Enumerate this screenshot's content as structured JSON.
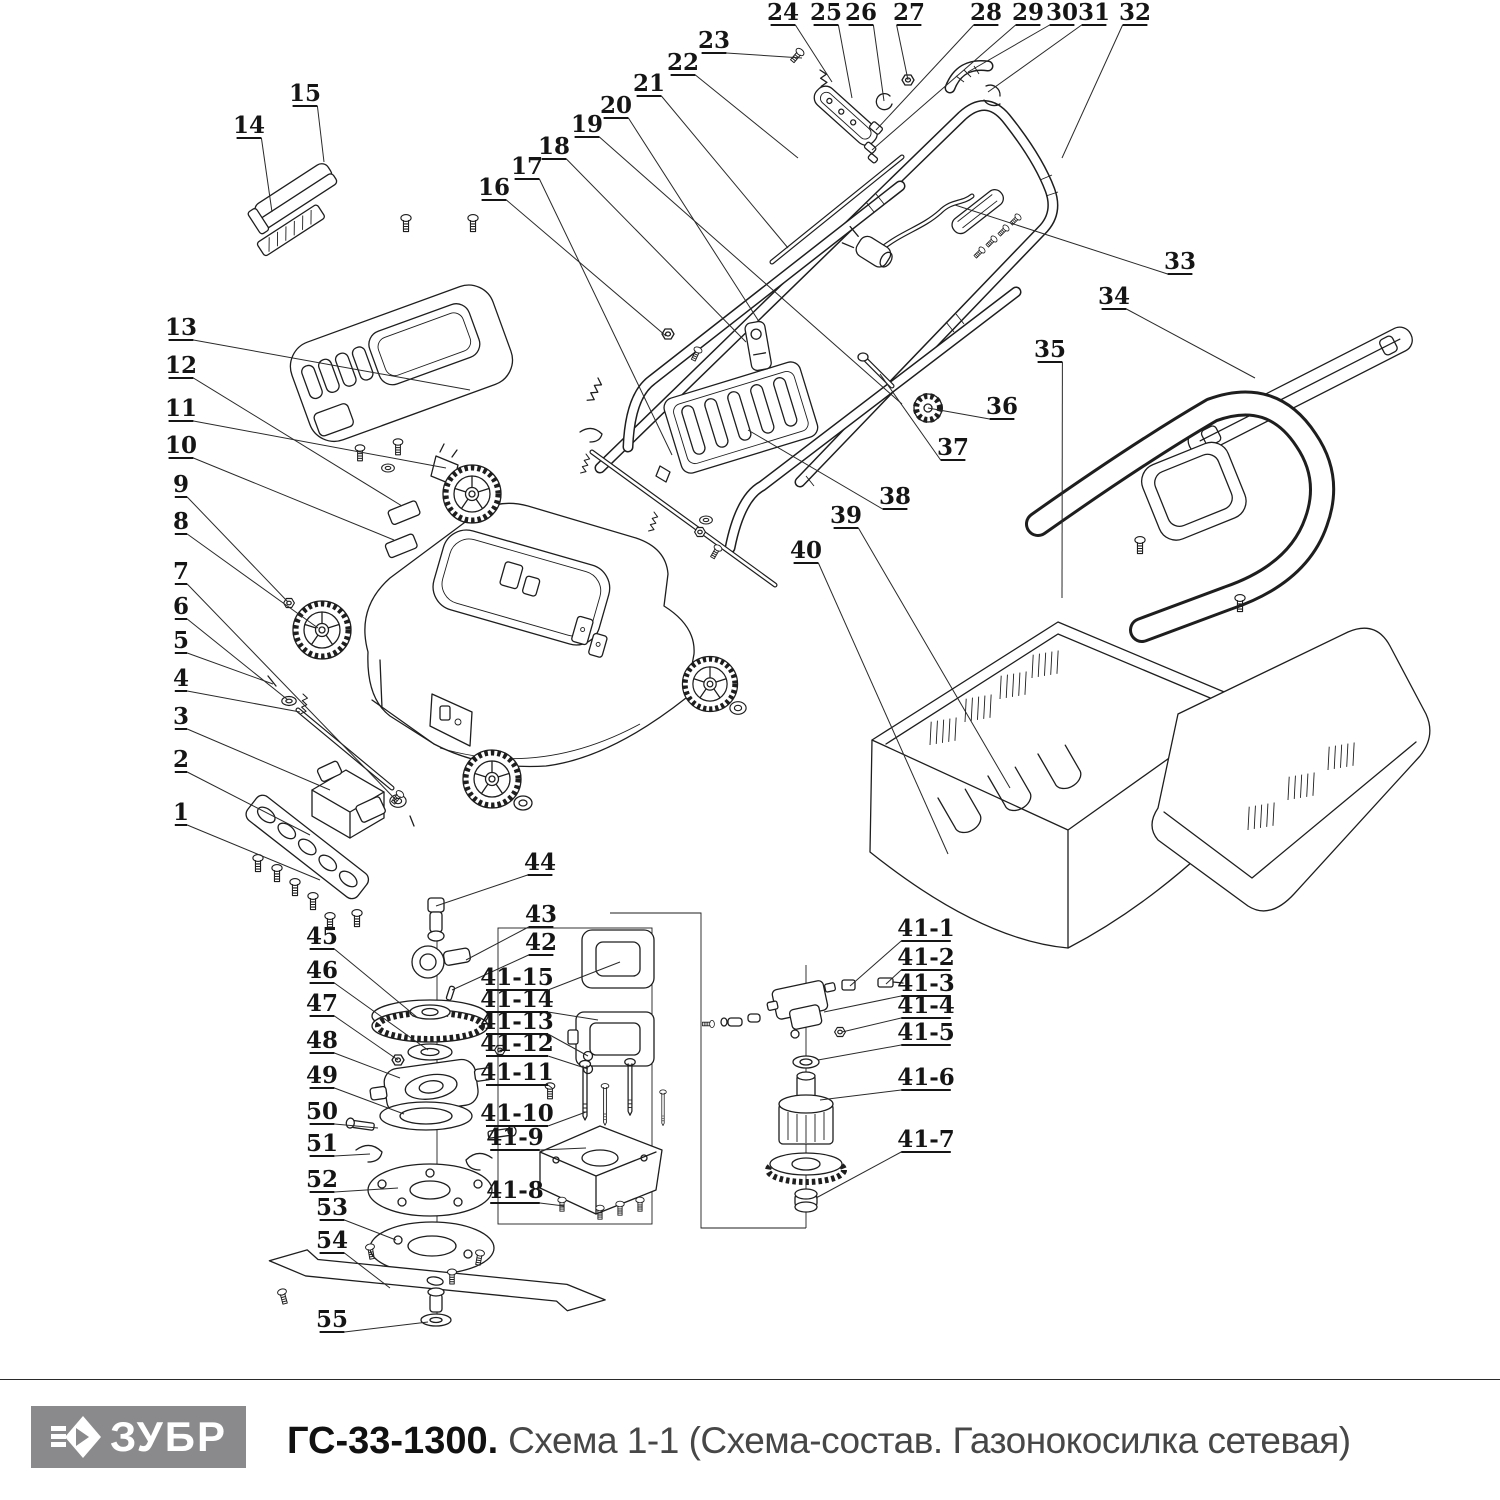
{
  "footer": {
    "brand": "ЗУБР",
    "model": "ГС-33-1300.",
    "subtitle": "Схема 1-1 (Схема-состав. Газонокосилка сетевая)"
  },
  "colors": {
    "line": "#1e1e1e",
    "logo_bg": "#8a8a8c",
    "model_text": "#111111",
    "subtitle_text": "#474747"
  },
  "callouts": [
    {
      "label": "1",
      "x": 181,
      "y": 818,
      "tx": 320,
      "ty": 880
    },
    {
      "label": "2",
      "x": 181,
      "y": 765,
      "tx": 310,
      "ty": 835
    },
    {
      "label": "3",
      "x": 181,
      "y": 722,
      "tx": 330,
      "ty": 790
    },
    {
      "label": "4",
      "x": 181,
      "y": 684,
      "tx": 300,
      "ty": 712
    },
    {
      "label": "5",
      "x": 181,
      "y": 646,
      "tx": 273,
      "ty": 684
    },
    {
      "label": "6",
      "x": 181,
      "y": 612,
      "tx": 288,
      "ty": 700
    },
    {
      "label": "7",
      "x": 181,
      "y": 577,
      "tx": 396,
      "ty": 800
    },
    {
      "label": "8",
      "x": 181,
      "y": 527,
      "tx": 318,
      "ty": 628
    },
    {
      "label": "9",
      "x": 181,
      "y": 490,
      "tx": 288,
      "ty": 602
    },
    {
      "label": "10",
      "x": 181,
      "y": 451,
      "tx": 394,
      "ty": 540
    },
    {
      "label": "11",
      "x": 181,
      "y": 414,
      "tx": 446,
      "ty": 468
    },
    {
      "label": "12",
      "x": 181,
      "y": 371,
      "tx": 402,
      "ty": 506
    },
    {
      "label": "13",
      "x": 181,
      "y": 333,
      "tx": 470,
      "ty": 390
    },
    {
      "label": "14",
      "x": 249,
      "y": 131,
      "tx": 272,
      "ty": 212
    },
    {
      "label": "15",
      "x": 305,
      "y": 99,
      "tx": 324,
      "ty": 162
    },
    {
      "label": "16",
      "x": 494,
      "y": 193,
      "tx": 666,
      "ty": 336
    },
    {
      "label": "17",
      "x": 527,
      "y": 172,
      "tx": 672,
      "ty": 455
    },
    {
      "label": "18",
      "x": 554,
      "y": 152,
      "tx": 746,
      "ty": 342
    },
    {
      "label": "19",
      "x": 587,
      "y": 130,
      "tx": 902,
      "ty": 404
    },
    {
      "label": "20",
      "x": 616,
      "y": 111,
      "tx": 758,
      "ty": 320
    },
    {
      "label": "21",
      "x": 649,
      "y": 89,
      "tx": 788,
      "ty": 248
    },
    {
      "label": "22",
      "x": 683,
      "y": 68,
      "tx": 798,
      "ty": 158
    },
    {
      "label": "23",
      "x": 714,
      "y": 46,
      "tx": 802,
      "ty": 58
    },
    {
      "label": "24",
      "x": 783,
      "y": 18,
      "tx": 832,
      "ty": 82
    },
    {
      "label": "25",
      "x": 826,
      "y": 18,
      "tx": 852,
      "ty": 98
    },
    {
      "label": "26",
      "x": 861,
      "y": 18,
      "tx": 884,
      "ty": 101
    },
    {
      "label": "27",
      "x": 909,
      "y": 18,
      "tx": 908,
      "ty": 80
    },
    {
      "label": "28",
      "x": 986,
      "y": 18,
      "tx": 876,
      "ty": 130
    },
    {
      "label": "29",
      "x": 1028,
      "y": 18,
      "tx": 872,
      "ty": 150
    },
    {
      "label": "30",
      "x": 1062,
      "y": 18,
      "tx": 968,
      "ty": 72
    },
    {
      "label": "31",
      "x": 1094,
      "y": 18,
      "tx": 988,
      "ty": 92
    },
    {
      "label": "32",
      "x": 1135,
      "y": 18,
      "tx": 1062,
      "ty": 158
    },
    {
      "label": "33",
      "x": 1180,
      "y": 267,
      "tx": 955,
      "ty": 205
    },
    {
      "label": "34",
      "x": 1114,
      "y": 302,
      "tx": 1255,
      "ty": 378
    },
    {
      "label": "35",
      "x": 1050,
      "y": 355,
      "tx": 1062,
      "ty": 598
    },
    {
      "label": "36",
      "x": 1002,
      "y": 412,
      "tx": 928,
      "ty": 408
    },
    {
      "label": "37",
      "x": 953,
      "y": 453,
      "tx": 880,
      "ty": 374
    },
    {
      "label": "38",
      "x": 895,
      "y": 502,
      "tx": 748,
      "ty": 430
    },
    {
      "label": "39",
      "x": 846,
      "y": 521,
      "tx": 1010,
      "ty": 788
    },
    {
      "label": "40",
      "x": 806,
      "y": 556,
      "tx": 948,
      "ty": 854
    },
    {
      "label": "44",
      "x": 540,
      "y": 868,
      "tx": 436,
      "ty": 906
    },
    {
      "label": "43",
      "x": 541,
      "y": 920,
      "tx": 466,
      "ty": 960
    },
    {
      "label": "42",
      "x": 541,
      "y": 948,
      "tx": 452,
      "ty": 990
    },
    {
      "label": "45",
      "x": 322,
      "y": 942,
      "tx": 418,
      "ty": 1018
    },
    {
      "label": "46",
      "x": 322,
      "y": 976,
      "tx": 428,
      "ty": 1050
    },
    {
      "label": "47",
      "x": 322,
      "y": 1009,
      "tx": 398,
      "ty": 1060
    },
    {
      "label": "48",
      "x": 322,
      "y": 1046,
      "tx": 400,
      "ty": 1078
    },
    {
      "label": "49",
      "x": 322,
      "y": 1081,
      "tx": 404,
      "ty": 1114
    },
    {
      "label": "50",
      "x": 322,
      "y": 1117,
      "tx": 378,
      "ty": 1128
    },
    {
      "label": "51",
      "x": 322,
      "y": 1149,
      "tx": 370,
      "ty": 1154
    },
    {
      "label": "52",
      "x": 322,
      "y": 1185,
      "tx": 398,
      "ty": 1188
    },
    {
      "label": "53",
      "x": 332,
      "y": 1213,
      "tx": 396,
      "ty": 1240
    },
    {
      "label": "54",
      "x": 332,
      "y": 1246,
      "tx": 390,
      "ty": 1288
    },
    {
      "label": "55",
      "x": 332,
      "y": 1325,
      "tx": 428,
      "ty": 1322
    },
    {
      "label": "41-15",
      "x": 517,
      "y": 983,
      "tx": 620,
      "ty": 962
    },
    {
      "label": "41-14",
      "x": 517,
      "y": 1005,
      "tx": 598,
      "ty": 1020
    },
    {
      "label": "41-13",
      "x": 517,
      "y": 1027,
      "tx": 588,
      "ty": 1056
    },
    {
      "label": "41-12",
      "x": 517,
      "y": 1049,
      "tx": 588,
      "ty": 1069
    },
    {
      "label": "41-11",
      "x": 517,
      "y": 1078,
      "tx": 552,
      "ty": 1088
    },
    {
      "label": "41-10",
      "x": 517,
      "y": 1119,
      "tx": 586,
      "ty": 1112
    },
    {
      "label": "41-9",
      "x": 515,
      "y": 1143,
      "tx": 586,
      "ty": 1148
    },
    {
      "label": "41-8",
      "x": 515,
      "y": 1196,
      "tx": 564,
      "ty": 1206
    },
    {
      "label": "41-1",
      "x": 926,
      "y": 934,
      "tx": 850,
      "ty": 986
    },
    {
      "label": "41-2",
      "x": 926,
      "y": 963,
      "tx": 886,
      "ty": 984
    },
    {
      "label": "41-3",
      "x": 926,
      "y": 989,
      "tx": 824,
      "ty": 1012
    },
    {
      "label": "41-4",
      "x": 926,
      "y": 1011,
      "tx": 842,
      "ty": 1032
    },
    {
      "label": "41-5",
      "x": 926,
      "y": 1038,
      "tx": 818,
      "ty": 1060
    },
    {
      "label": "41-6",
      "x": 926,
      "y": 1083,
      "tx": 820,
      "ty": 1100
    },
    {
      "label": "41-7",
      "x": 926,
      "y": 1145,
      "tx": 816,
      "ty": 1198
    }
  ]
}
